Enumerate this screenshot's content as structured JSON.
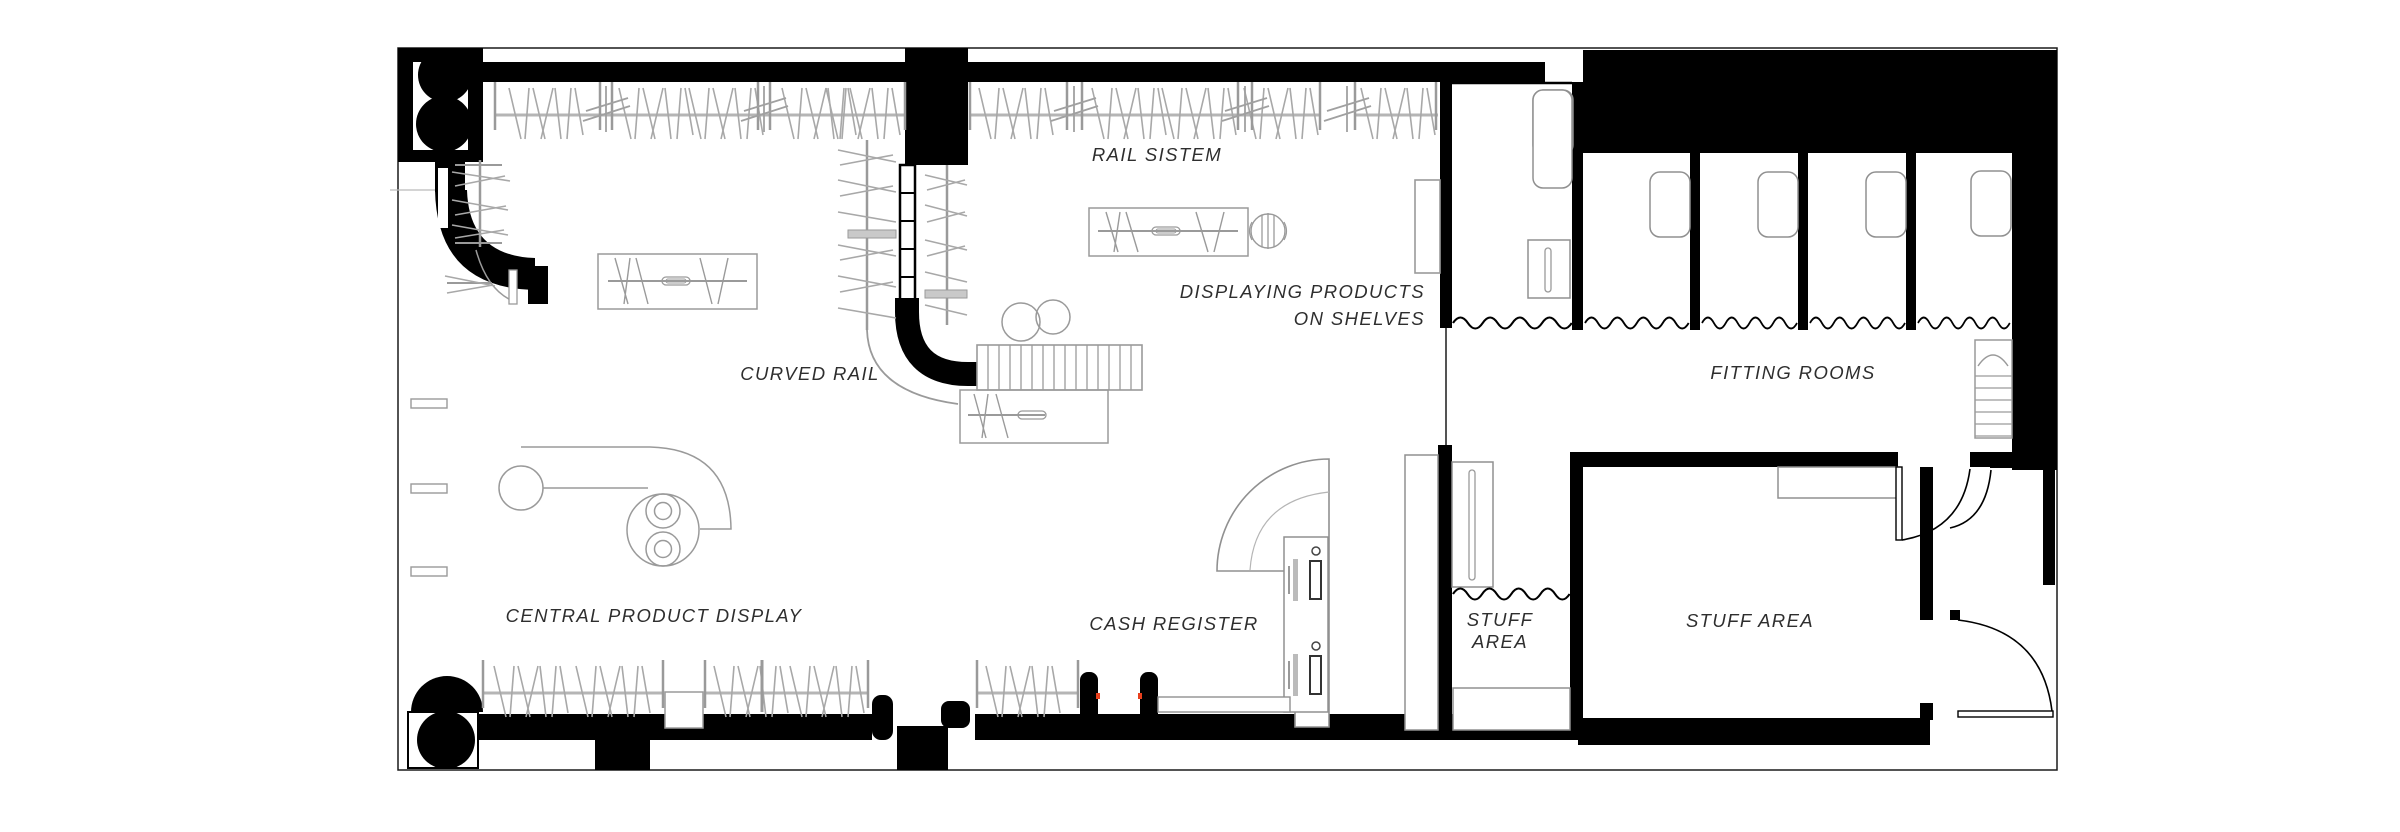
{
  "plan": {
    "type": "retail store floor plan",
    "labels": {
      "rail_system": "RAIL SISTEM",
      "displaying_products_line1": "DISPLAYING PRODUCTS",
      "displaying_products_line2": "ON SHELVES",
      "curved_rail": "CURVED RAIL",
      "fitting_rooms": "FITTING ROOMS",
      "central_product_display": "CENTRAL PRODUCT DISPLAY",
      "cash_register": "CASH REGISTER",
      "stuff_area_small_line1": "STUFF",
      "stuff_area_small_line2": "AREA",
      "stuff_area_large": "STUFF AREA"
    },
    "palette": {
      "background": "#ffffff",
      "wall": "#000000",
      "outline": "#1a1a1a",
      "furniture_line": "#909090",
      "rack_line": "#a8a8a8",
      "label_text": "#2e2e2e",
      "accent_red": "#e8401d"
    }
  }
}
